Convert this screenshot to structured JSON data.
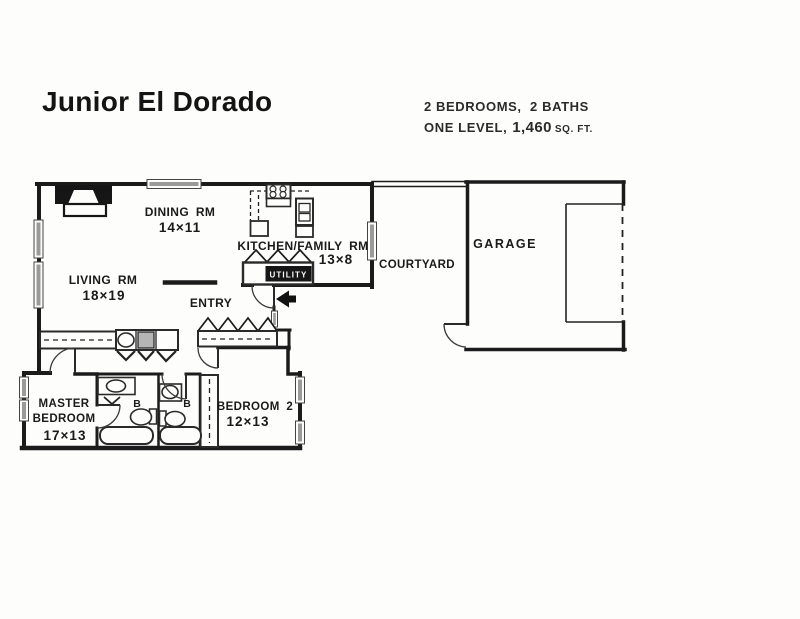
{
  "page": {
    "title": "Junior El Dorado"
  },
  "specs": {
    "line1": "2 BEDROOMS,  2 BATHS",
    "line2_prefix": "ONE LEVEL,",
    "area": "1,460",
    "area_unit": "SQ. FT."
  },
  "rooms": {
    "dining": {
      "name": "DINING RM",
      "dims": "14×11"
    },
    "living": {
      "name": "LIVING RM",
      "dims": "18×19"
    },
    "kitchen": {
      "name": "KITCHEN/FAMILY RM",
      "dims": "13×8"
    },
    "entry": {
      "name": "ENTRY"
    },
    "courtyard": {
      "name": "COURTYARD"
    },
    "garage": {
      "name": "GARAGE"
    },
    "master": {
      "name_line1": "MASTER",
      "name_line2": "BEDROOM",
      "dims": "17×13"
    },
    "bedroom2": {
      "name": "BEDROOM 2",
      "dims": "12×13"
    },
    "bath1": {
      "abbr": "B"
    },
    "bath2": {
      "abbr": "B"
    },
    "utility": {
      "name": "UTILITY"
    }
  },
  "colors": {
    "ink": "#1b1b1b",
    "window_fill": "#9a9a9a",
    "paper": "#fdfdfc"
  }
}
